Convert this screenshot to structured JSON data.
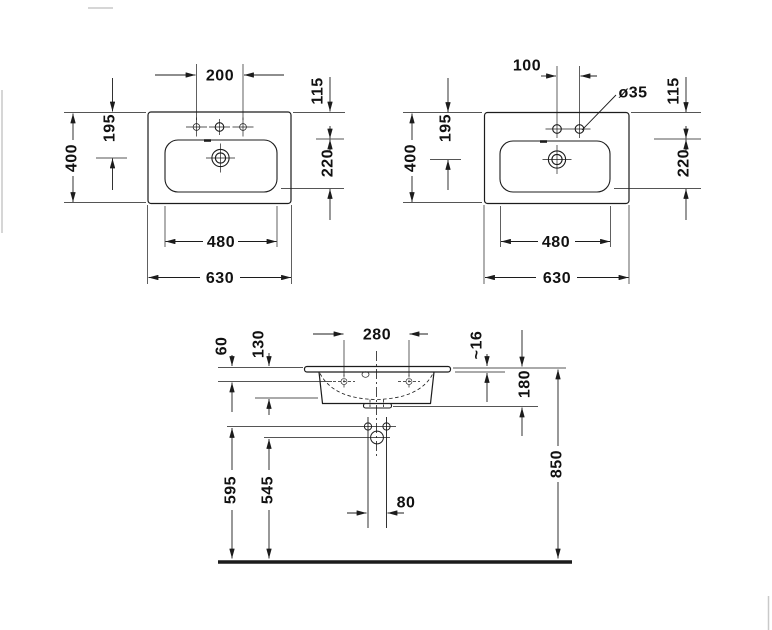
{
  "views": {
    "top_left": {
      "d200": "200",
      "d115": "115",
      "d195": "195",
      "d400": "400",
      "d220": "220",
      "d480": "480",
      "d630": "630"
    },
    "top_right": {
      "d100": "100",
      "dia35": "ø35",
      "d115": "115",
      "d195": "195",
      "d400": "400",
      "d220": "220",
      "d480": "480",
      "d630": "630"
    },
    "front": {
      "d60": "60",
      "d130": "130",
      "d280": "280",
      "d16": "~16",
      "d180": "180",
      "d595": "595",
      "d545": "545",
      "d850": "850",
      "d80": "80"
    }
  },
  "colors": {
    "line": "#1c1c1c",
    "background": "#ffffff"
  }
}
